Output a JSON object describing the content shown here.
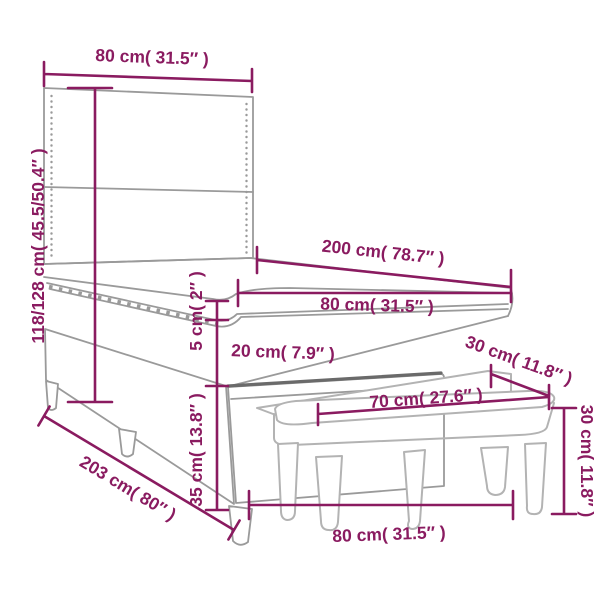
{
  "diagram": {
    "kind": "product-dimension-diagram",
    "product": "box spring bed with headboard, topper mattress and bench",
    "background_color": "#ffffff",
    "dimension_color": "#8a1b60",
    "bed_line_color": "#9a9a9a",
    "bench_line_color": "#b3b3b3",
    "accent_dark_color": "#6a6a6a"
  },
  "annotations": {
    "headboard_width": "80 cm( 31.5″ )",
    "total_height": "118/128 cm( 45.5/50.4″ )",
    "bed_length_top": "200 cm( 78.7″ )",
    "mattress_width": "80 cm( 31.5″ )",
    "topper_height": "5 cm( 2″ )",
    "mattress_height": "20 cm( 7.9″ )",
    "base_height": "35 cm( 13.8″ )",
    "bed_total_length": "203 cm( 80″ )",
    "bench_depth": "30 cm( 11.8″ )",
    "bench_height": "30 cm( 11.8″ )",
    "bench_seat_length": "70 cm( 27.6″ )",
    "bench_total_length": "80 cm( 31.5″ )"
  }
}
